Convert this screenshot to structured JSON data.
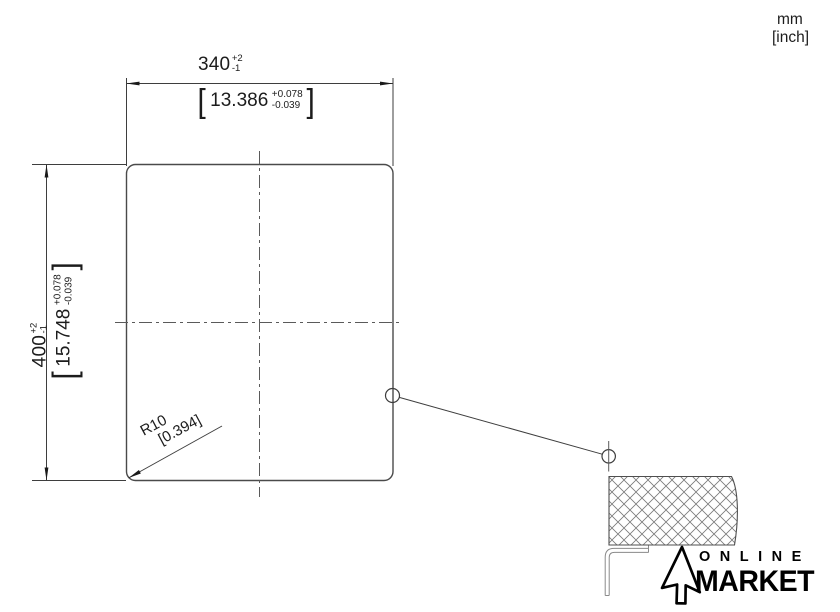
{
  "units": {
    "primary": "mm",
    "secondary": "[inch]"
  },
  "brackets": {
    "open": "[",
    "close": "]"
  },
  "dimensions": {
    "width": {
      "mm": "340",
      "tol_plus": "+2",
      "tol_minus": "-1",
      "inch": "13.386",
      "inch_tol_plus": "+0.078",
      "inch_tol_minus": "-0.039"
    },
    "height": {
      "mm": "400",
      "tol_plus": "+2",
      "tol_minus": "-1",
      "inch": "15.748",
      "inch_tol_plus": "+0.078",
      "inch_tol_minus": "-0.039"
    },
    "corner_radius": {
      "mm": "R10",
      "inch": "[0.394]"
    }
  },
  "logo": {
    "line1": "ONLINE",
    "line2": "MARKET",
    "icon": "cursor-arrow-icon"
  },
  "colors": {
    "background": "#ffffff",
    "outline": "#4a4a4a",
    "dimension_lines": "#3e3e3e",
    "centerline": "#5a5a5a",
    "hatch": "#7a7a7a",
    "rim_profile": "#8a8a8a",
    "text": "#1c1c1c",
    "logo": "#000000"
  }
}
